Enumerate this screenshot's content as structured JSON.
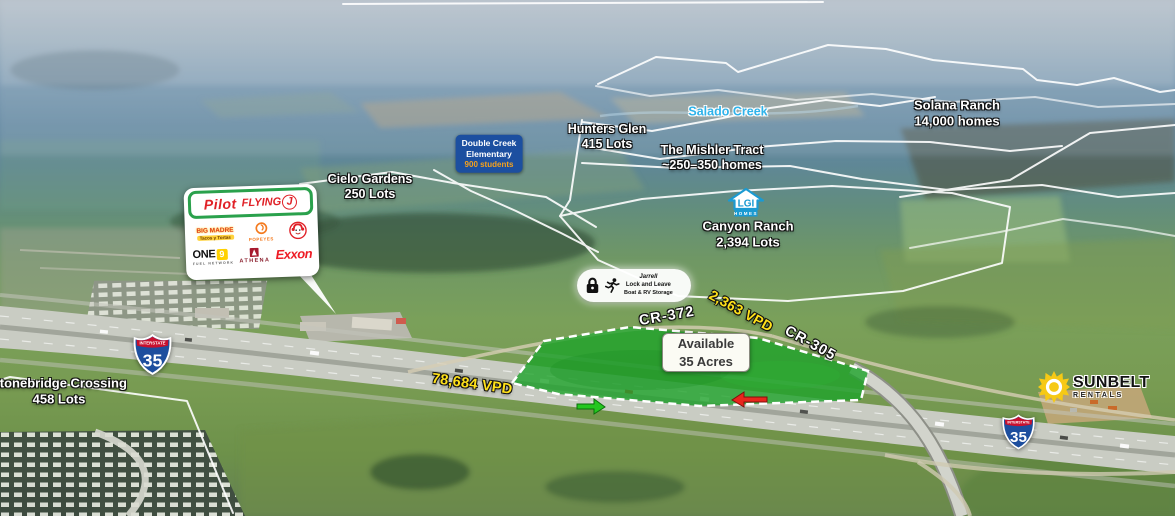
{
  "colors": {
    "parcel_green": "#1ea32b",
    "traffic_yellow": "#ffe11a",
    "creek_blue": "#2fb3ea",
    "school_badge_blue": "#1c4fa0",
    "students_orange": "#f6a21c",
    "lgi_blue": "#1b9ad2",
    "shield_blue": "#1d4e9e",
    "shield_red": "#c8102e",
    "pilot_green": "#2aa14c",
    "pilot_red": "#e02127",
    "exxon_red": "#ee1c25",
    "one9_yellow": "#ffd100",
    "sunbelt_yellow": "#f6c915",
    "arrow_green": "#24c71f",
    "arrow_red": "#e8261d",
    "label_white": "#ffffff"
  },
  "areas": {
    "salado_creek": {
      "label": "Salado Creek"
    },
    "solana_ranch": {
      "name": "Solana Ranch",
      "detail": "14,000 homes"
    },
    "hunters_glen": {
      "name": "Hunters Glen",
      "detail": "415 Lots"
    },
    "mishler_tract": {
      "name": "The Mishler Tract",
      "detail": "~250–350 homes"
    },
    "double_creek_elementary": {
      "line1": "Double Creek",
      "line2": "Elementary",
      "line3": "900 students"
    },
    "cielo_gardens": {
      "name": "Cielo Gardens",
      "detail": "250 Lots"
    },
    "canyon_ranch": {
      "name": "Canyon Ranch",
      "detail": "2,394 Lots",
      "builder_abbr": "LGI",
      "builder_word": "HOMES"
    },
    "stonebridge_crossing": {
      "name": "Stonebridge Crossing",
      "detail": "458 Lots"
    }
  },
  "roads": {
    "cr_372": "CR-372",
    "cr_305": "CR-305",
    "interstate_shield": {
      "top": "INTERSTATE",
      "number": "35"
    },
    "i35_traffic": "78,684 VPD",
    "cr372_traffic": "2,363 VPD"
  },
  "site": {
    "line1": "Available",
    "line2": "35 Acres"
  },
  "storage_callout": {
    "line1": "Jarrell",
    "line2": "Lock and Leave",
    "line3": "Boat & RV Storage"
  },
  "travel_center": {
    "pilot": "Pilot",
    "flying": "FLYING",
    "j": "J",
    "big_madre": "BIG MADRE",
    "big_madre_sub": "Tacos y Tortas",
    "popeyes": "POPEYES",
    "one": "ONE",
    "nine": "9",
    "one9_sub": "FUEL NETWORK",
    "athena": "ATHENA",
    "exxon": "Exxon"
  },
  "sunbelt": {
    "name": "SUNBELT",
    "sub": "RENTALS"
  },
  "icons": {
    "lock": "padlock-icon",
    "runner": "running-person-icon",
    "sun": "sunburst-icon",
    "wendys": "wendys-girl-logo",
    "popeyes": "popeyes-rooster-icon",
    "lgi_house": "house-outline-icon",
    "green_arrow": "northbound-traffic-arrow",
    "red_arrow": "southbound-traffic-arrow"
  }
}
